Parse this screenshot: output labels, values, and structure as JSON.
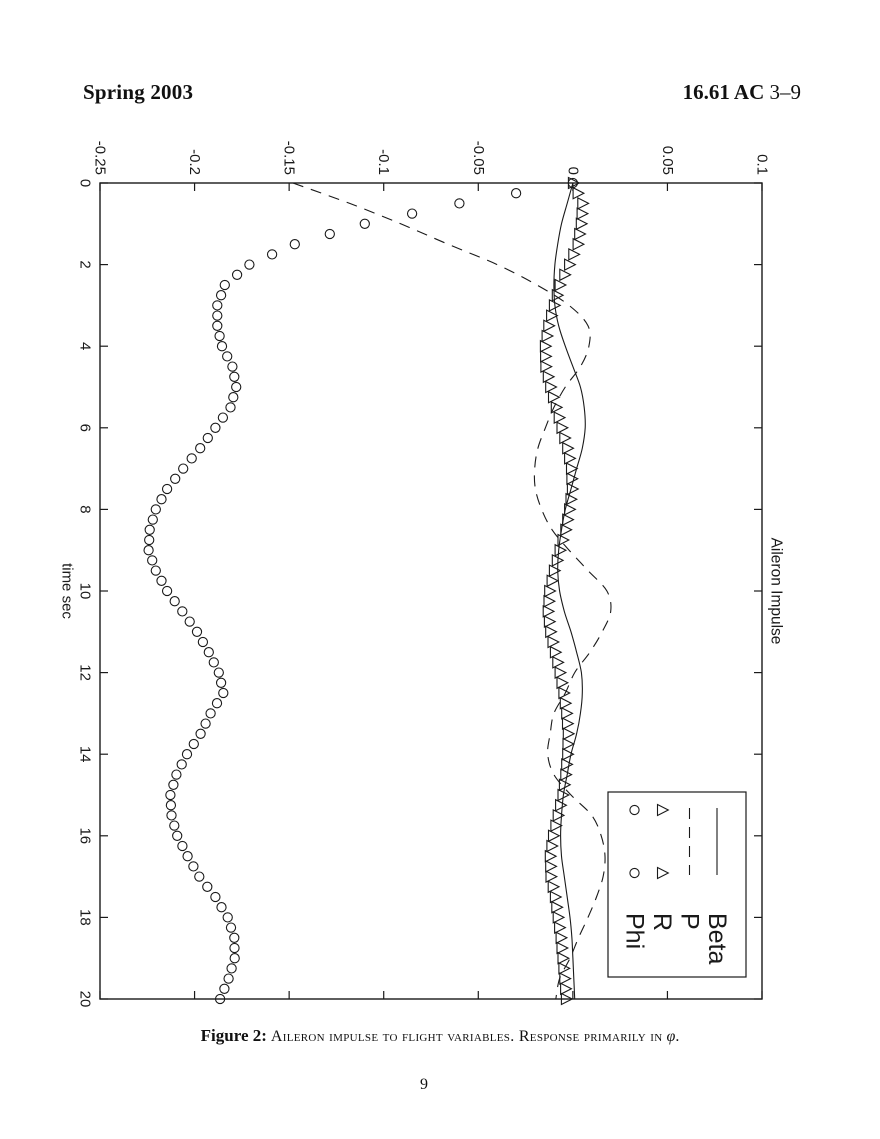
{
  "header": {
    "left": "Spring 2003",
    "right_bold": "16.61 AC",
    "right_rest": "3–9"
  },
  "caption": {
    "label": "Figure 2:",
    "body": "Aileron impulse to flight variables. Response primarily in",
    "symbol": "φ",
    "period": "."
  },
  "page_number": "9",
  "chart_data": {
    "type": "line",
    "title": "Aileron Impulse",
    "xlabel": "time sec",
    "ylabel": "",
    "xlim": [
      0,
      20
    ],
    "ylim": [
      -0.25,
      0.1
    ],
    "xticks": [
      0,
      2,
      4,
      6,
      8,
      10,
      12,
      14,
      16,
      18,
      20
    ],
    "xtick_labels": [
      "0",
      "2",
      "4",
      "6",
      "8",
      "10",
      "12",
      "14",
      "16",
      "18",
      "20"
    ],
    "yticks": [
      -0.25,
      -0.2,
      -0.15,
      -0.1,
      -0.05,
      0,
      0.05,
      0.1
    ],
    "ytick_labels": [
      "-0.25",
      "-0.2",
      "-0.15",
      "-0.1",
      "-0.05",
      "0",
      "0.05",
      "0.1"
    ],
    "grid": false,
    "frame_box": true,
    "line_color": "#1a1a1a",
    "background": "#ffffff",
    "orientation": "figure rotated 90 degrees clockwise on the page",
    "legend_position": "upper right",
    "legend_entries": [
      {
        "label": "Beta",
        "style": "solid"
      },
      {
        "label": "P",
        "style": "dashed"
      },
      {
        "label": "R",
        "style": "triangle-marker"
      },
      {
        "label": "Phi",
        "style": "circle-marker"
      }
    ],
    "x": [
      0,
      0.5,
      1,
      1.5,
      2,
      2.5,
      3,
      3.5,
      4,
      4.5,
      5,
      5.5,
      6,
      6.5,
      7,
      7.5,
      8,
      8.5,
      9,
      9.5,
      10,
      10.5,
      11,
      11.5,
      12,
      12.5,
      13,
      13.5,
      14,
      14.5,
      15,
      15.5,
      16,
      16.5,
      17,
      17.5,
      18,
      18.5,
      19,
      19.5,
      20
    ],
    "marker_render_step": 0.25,
    "series": [
      {
        "name": "Beta",
        "style": "solid",
        "values": [
          0,
          -0.003,
          -0.006,
          -0.008,
          -0.0095,
          -0.01,
          -0.0095,
          -0.0075,
          -0.004,
          0,
          0.004,
          0.006,
          0.0065,
          0.005,
          0.002,
          -0.001,
          -0.004,
          -0.006,
          -0.0075,
          -0.008,
          -0.007,
          -0.0045,
          -0.001,
          0.002,
          0.0045,
          0.005,
          0.004,
          0.002,
          -0.001,
          -0.003,
          -0.005,
          -0.006,
          -0.0065,
          -0.006,
          -0.0045,
          -0.003,
          -0.0015,
          -0.0005,
          0,
          0.0005,
          0.001
        ]
      },
      {
        "name": "P",
        "style": "dashed",
        "values": [
          -0.148,
          -0.118,
          -0.091,
          -0.066,
          -0.04,
          -0.019,
          -0.002,
          0.008,
          0.0085,
          0.004,
          -0.004,
          -0.01,
          -0.0145,
          -0.0185,
          -0.0202,
          -0.0198,
          -0.0165,
          -0.011,
          -0.002,
          0.008,
          0.018,
          0.02,
          0.0155,
          0.009,
          0.001,
          -0.004,
          -0.01,
          -0.012,
          -0.0133,
          -0.01,
          -0.001,
          0.01,
          0.015,
          0.017,
          0.016,
          0.0125,
          0.008,
          0.003,
          -0.0015,
          -0.007,
          -0.009
        ]
      },
      {
        "name": "R",
        "style": "triangle-marker",
        "values": [
          0,
          0.005,
          0.0042,
          0.0025,
          -0.002,
          -0.007,
          -0.01,
          -0.013,
          -0.0148,
          -0.0145,
          -0.012,
          -0.009,
          -0.006,
          -0.003,
          -0.001,
          -0.0005,
          -0.002,
          -0.004,
          -0.007,
          -0.01,
          -0.0125,
          -0.0133,
          -0.012,
          -0.0095,
          -0.007,
          -0.005,
          -0.0035,
          -0.0027,
          -0.003,
          -0.004,
          -0.0055,
          -0.008,
          -0.0105,
          -0.0122,
          -0.0118,
          -0.0095,
          -0.008,
          -0.0065,
          -0.0055,
          -0.0045,
          -0.0037
        ]
      },
      {
        "name": "Phi",
        "style": "circle-marker",
        "values": [
          0,
          -0.06,
          -0.11,
          -0.147,
          -0.171,
          -0.184,
          -0.188,
          -0.188,
          -0.1855,
          -0.18,
          -0.178,
          -0.181,
          -0.189,
          -0.197,
          -0.206,
          -0.2145,
          -0.2205,
          -0.2237,
          -0.2243,
          -0.2205,
          -0.2145,
          -0.2065,
          -0.1987,
          -0.1925,
          -0.1872,
          -0.1848,
          -0.1915,
          -0.1968,
          -0.204,
          -0.2096,
          -0.2128,
          -0.2122,
          -0.2092,
          -0.2037,
          -0.1975,
          -0.189,
          -0.1825,
          -0.179,
          -0.1788,
          -0.182,
          -0.1865
        ]
      }
    ]
  }
}
